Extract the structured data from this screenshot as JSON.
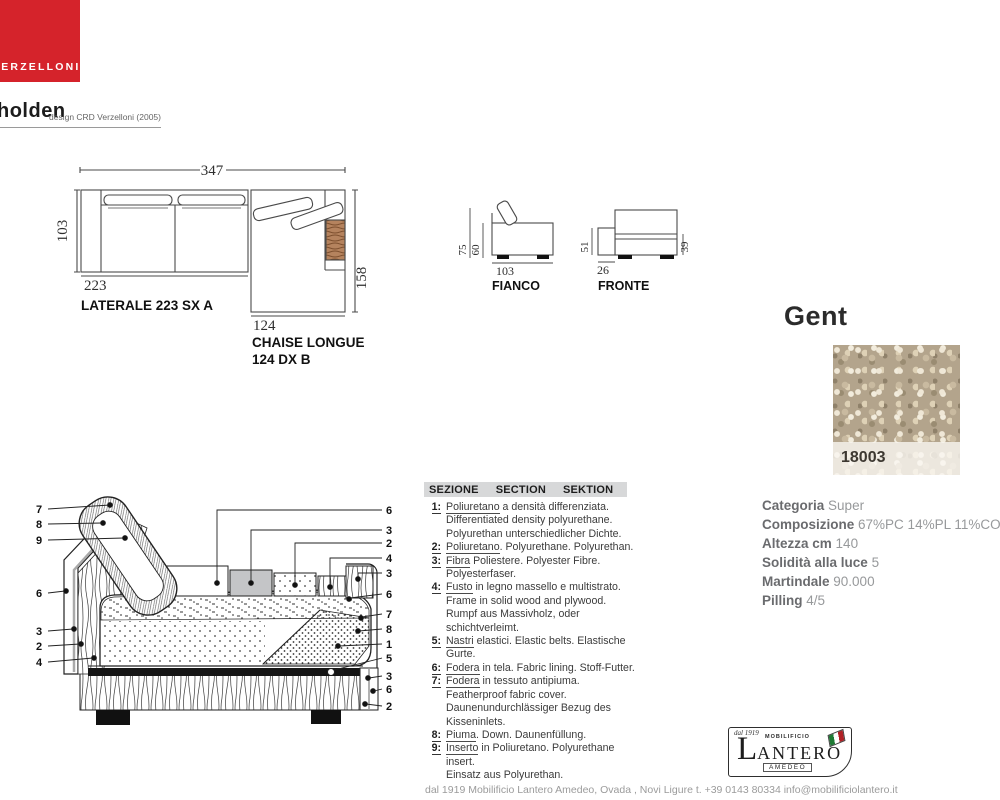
{
  "brand": {
    "logo_text": "VERZELLONI"
  },
  "product": {
    "name": "holden",
    "design_credit": "design CRD Verzelloni (2005)"
  },
  "plan": {
    "total_width": "347",
    "lateral": {
      "depth": "103",
      "width": "223",
      "label": "LATERALE 223 SX A"
    },
    "chaise": {
      "width": "124",
      "depth": "158",
      "label_line1": "CHAISE LONGUE",
      "label_line2": "124 DX B"
    }
  },
  "fianco": {
    "label": "FIANCO",
    "height_total": "75",
    "height_body": "60",
    "depth": "103"
  },
  "fronte": {
    "label": "FRONTE",
    "arm_height": "51",
    "arm_width": "26",
    "seat_height": "39"
  },
  "fabric": {
    "name": "Gent",
    "code": "18003",
    "specs": [
      {
        "label": "Categoria",
        "value": "Super"
      },
      {
        "label": "Composizione",
        "value": "67%PC 14%PL 11%CO 8%WC"
      },
      {
        "label": "Altezza cm",
        "value": "140"
      },
      {
        "label": "Solidità alla luce",
        "value": "5"
      },
      {
        "label": "Martindale",
        "value": "90.000"
      },
      {
        "label": "Pilling",
        "value": "4/5"
      }
    ]
  },
  "legend": {
    "header": {
      "it": "SEZIONE",
      "en": "SECTION",
      "de": "SEKTION"
    },
    "items": [
      {
        "num": "1:",
        "lead": "Poliuretano",
        "rest": " a densità differenziata.",
        "extra": [
          "Differentiated density polyurethane.",
          "Polyurethan unterschiedlicher Dichte."
        ]
      },
      {
        "num": "2:",
        "lead": "Poliuretano",
        "rest": ". Polyurethane. Polyurethan.",
        "extra": []
      },
      {
        "num": "3:",
        "lead": "Fibra",
        "rest": " Poliestere. Polyester Fibre.",
        "extra": [
          "Polyesterfaser."
        ]
      },
      {
        "num": "4:",
        "lead": "Fusto",
        "rest": " in legno massello e multistrato.",
        "extra": [
          "Frame in solid wood and plywood.",
          "Rumpf aus Massivholz, oder schichtverleimt."
        ]
      },
      {
        "num": "5:",
        "lead": "Nastri",
        "rest": " elastici. Elastic belts. Elastische Gurte.",
        "extra": []
      },
      {
        "num": "6:",
        "lead": "Fodera",
        "rest": " in tela. Fabric lining. Stoff-Futter.",
        "extra": []
      },
      {
        "num": "7:",
        "lead": "Fodera",
        "rest": " in tessuto antipiuma.",
        "extra": [
          "Featherproof fabric cover.",
          "Daunenundurchlässiger Bezug des Kisseninlets."
        ]
      },
      {
        "num": "8:",
        "lead": "Piuma",
        "rest": ". Down. Daunenfüllung.",
        "extra": []
      },
      {
        "num": "9:",
        "lead": "Inserto",
        "rest": " in Poliuretano. Polyurethane insert.",
        "extra": [
          "Einsatz aus Polyurethan."
        ]
      }
    ]
  },
  "section": {
    "left_callouts": [
      "7",
      "8",
      "9",
      "6",
      "3",
      "2",
      "4"
    ],
    "right_callouts": [
      "6",
      "3",
      "2",
      "4",
      "3",
      "6",
      "7",
      "8",
      "1",
      "5",
      "3",
      "6",
      "2"
    ]
  },
  "lantero": {
    "dal": "dal 1919",
    "mobilificio": "MOBILIFICIO",
    "name_initial": "L",
    "name_rest": "ANTERO",
    "amedeo": "AMEDEO"
  },
  "footer": {
    "line": "dal 1919 Mobilificio Lantero Amedeo,   Ovada , Novi Ligure   t. +39 0143 80334   info@mobilificiolantero.it"
  },
  "colors": {
    "brand_red": "#d5232b",
    "wood_brown": "#b5835e",
    "swatch_base": "#b3a48c",
    "legend_bar": "#d7d8d9"
  }
}
